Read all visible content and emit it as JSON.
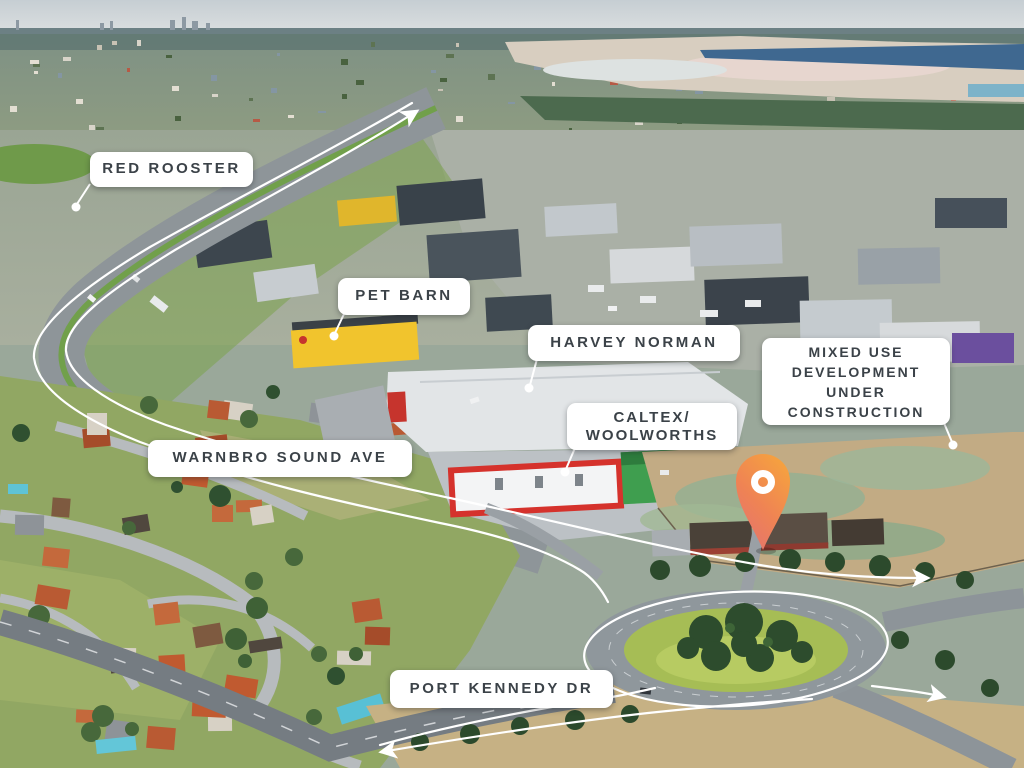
{
  "map": {
    "labels": {
      "red_rooster": {
        "lines": [
          "RED ROOSTER"
        ]
      },
      "pet_barn": {
        "lines": [
          "PET BARN"
        ]
      },
      "harvey_norman": {
        "lines": [
          "HARVEY NORMAN"
        ]
      },
      "mixed_use": {
        "lines": [
          "MIXED USE",
          "DEVELOPMENT",
          "UNDER",
          "CONSTRUCTION"
        ]
      },
      "caltex_woolworths": {
        "lines": [
          "CALTEX/",
          "WOOLWORTHS"
        ]
      },
      "warnbro_sound_ave": {
        "lines": [
          "WARNBRO SOUND AVE"
        ]
      },
      "port_kennedy_dr": {
        "lines": [
          "PORT KENNEDY DR"
        ]
      }
    },
    "pin": {
      "name": "location-pin"
    },
    "colors": {
      "label_background": "#ffffff",
      "label_text": "#3b4248",
      "trace": "#ffffff",
      "pin_gradient_top": "#F6A33E",
      "pin_gradient_mid": "#EF8354",
      "pin_gradient_bottom": "#E4746F"
    }
  }
}
